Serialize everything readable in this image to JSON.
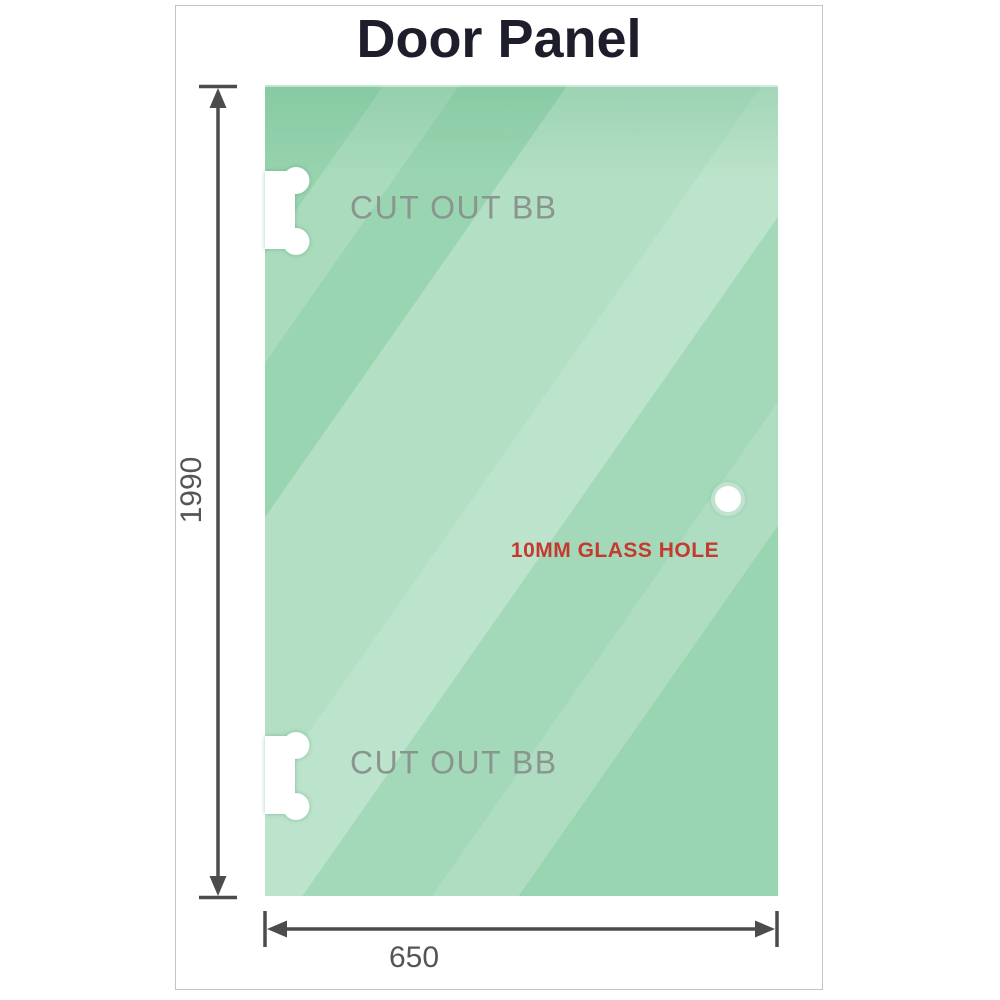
{
  "title": "Door Panel",
  "panel": {
    "cutout_top_label": "CUT OUT BB",
    "cutout_bottom_label": "CUT OUT BB",
    "hole_label": "10MM GLASS HOLE"
  },
  "dimensions": {
    "height_label": "1990",
    "width_label": "650"
  },
  "colors": {
    "glass-green": "#8ccfa6",
    "dim-color": "#4c4c4c",
    "cutout-label-color": "#8a958f",
    "hole-label-color": "#c43a2e",
    "title-color": "#1d1d2b",
    "frame-border": "#c1c5c1",
    "text-gray": "#555555"
  }
}
